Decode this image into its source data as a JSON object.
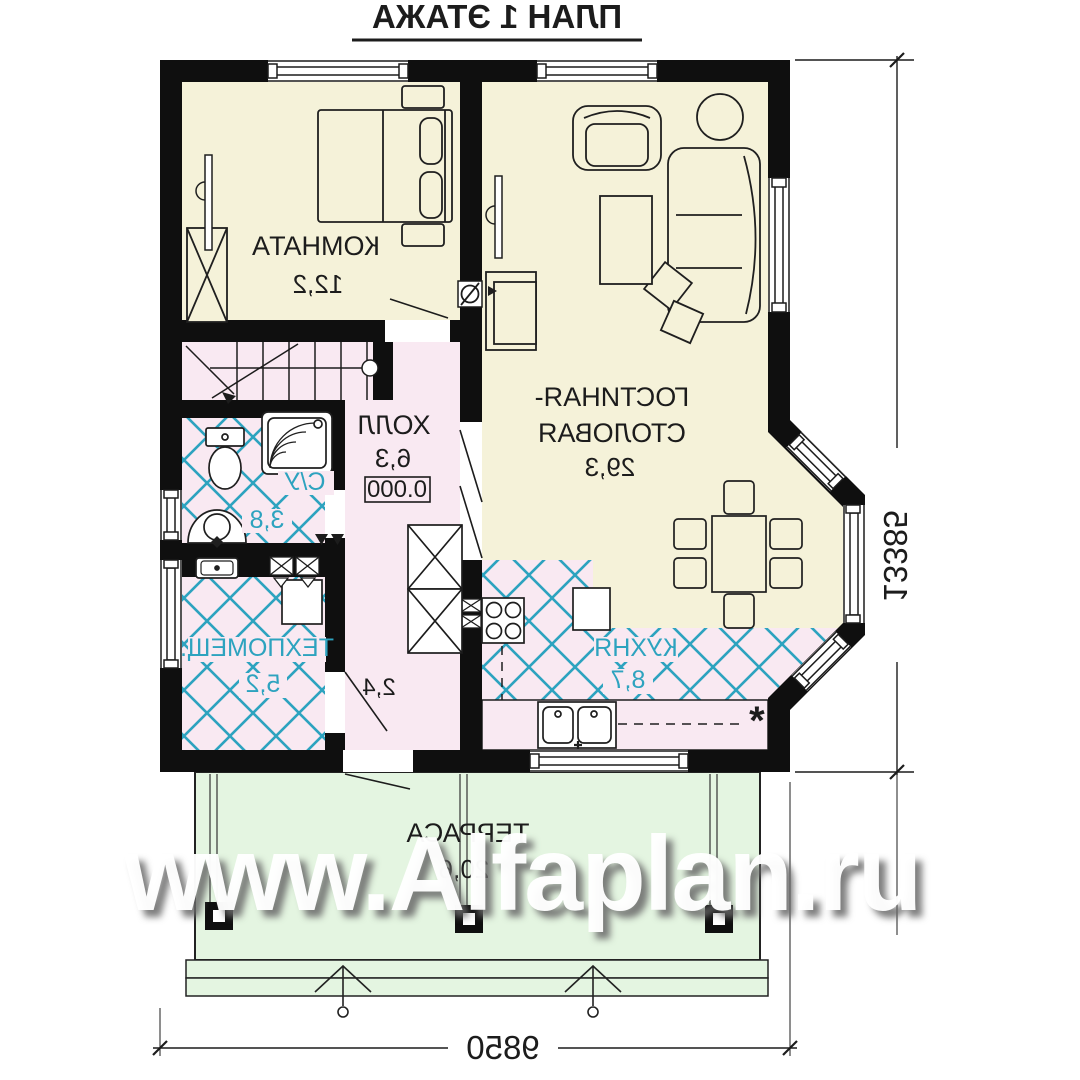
{
  "title": "ПЛАН 1 ЭТАЖА",
  "watermark": "www.Alfaplan.ru",
  "rooms": {
    "bedroom": {
      "label": "КОМНАТА",
      "area": "12,2"
    },
    "living": {
      "label_line1": "ГОСТИНАЯ-",
      "label_line2": "СТОЛОВАЯ",
      "area": "29,3"
    },
    "hall": {
      "label": "ХОЛЛ",
      "area": "6,3",
      "elevation": "0.000"
    },
    "bathroom": {
      "label": "С/У",
      "area": "3,8"
    },
    "tech": {
      "label": "ТЕХПОМЕЩ.",
      "area": "5,2"
    },
    "corridor": {
      "area": "2,4"
    },
    "kitchen": {
      "label": "КУХНЯ",
      "area": "8,7",
      "note": "*"
    },
    "terrace": {
      "label": "ТЕРРАСА",
      "area": "20,6"
    }
  },
  "dimensions": {
    "vertical": "13385",
    "horizontal": "9850"
  },
  "colors": {
    "wall": "#0f0f0f",
    "room_beige": "#f5f2d9",
    "room_pink": "#f9e9f2",
    "terrace_green": "#e4f5e1",
    "tile_teal": "#2da3bf",
    "watermark": "#ffffff"
  }
}
